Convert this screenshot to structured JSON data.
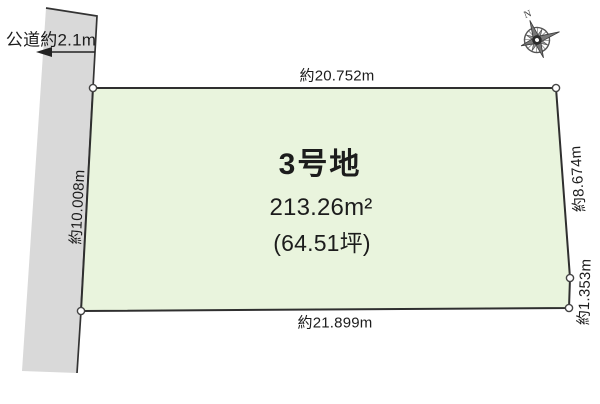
{
  "diagram": {
    "compass": {
      "north_label": "N"
    },
    "road": {
      "label": "公道約2.1m"
    },
    "plot": {
      "name": "3号地",
      "area_m2": "213.26m²",
      "area_tsubo": "(64.51坪)"
    },
    "dimensions": {
      "top": "約20.752m",
      "bottom": "約21.899m",
      "right_upper": "約8.674m",
      "right_lower": "約1.353m",
      "left": "約10.008m"
    },
    "colors": {
      "plot_fill": "#e9f4dd",
      "road_fill": "#d9d9d9",
      "line": "#333333"
    }
  }
}
